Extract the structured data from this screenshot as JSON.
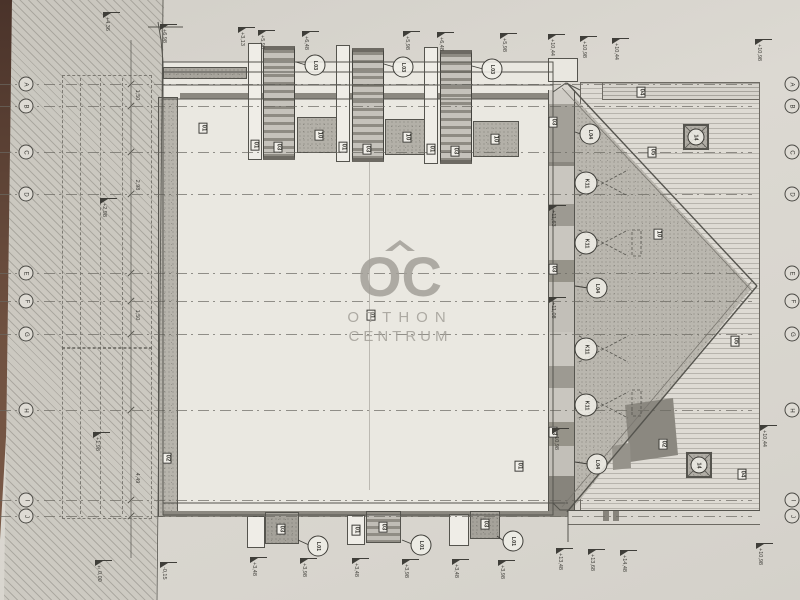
{
  "watermark": {
    "logo": "OC",
    "line1": "OTTHON",
    "line2": "CENTRUM"
  },
  "grid": {
    "x_left": 26,
    "x_right": 792,
    "rows": [
      {
        "letter": "A",
        "y": 84
      },
      {
        "letter": "B",
        "y": 106
      },
      {
        "letter": "C",
        "y": 152
      },
      {
        "letter": "D",
        "y": 194
      },
      {
        "letter": "E",
        "y": 273
      },
      {
        "letter": "F",
        "y": 301
      },
      {
        "letter": "G",
        "y": 334
      },
      {
        "letter": "H",
        "y": 410
      },
      {
        "letter": "I",
        "y": 500
      },
      {
        "letter": "J",
        "y": 516
      }
    ]
  },
  "box_labels": [
    {
      "text": "01",
      "x": 203,
      "y": 128
    },
    {
      "text": "01",
      "x": 255,
      "y": 145
    },
    {
      "text": "03",
      "x": 278,
      "y": 147
    },
    {
      "text": "10",
      "x": 319,
      "y": 135
    },
    {
      "text": "01",
      "x": 343,
      "y": 147
    },
    {
      "text": "03",
      "x": 367,
      "y": 149
    },
    {
      "text": "10",
      "x": 407,
      "y": 137
    },
    {
      "text": "01",
      "x": 431,
      "y": 149
    },
    {
      "text": "03",
      "x": 455,
      "y": 151
    },
    {
      "text": "10",
      "x": 495,
      "y": 139
    },
    {
      "text": "03",
      "x": 553,
      "y": 122
    },
    {
      "text": "03",
      "x": 553,
      "y": 269
    },
    {
      "text": "03",
      "x": 553,
      "y": 432
    },
    {
      "text": "01",
      "x": 371,
      "y": 315
    },
    {
      "text": "01",
      "x": 519,
      "y": 466
    },
    {
      "text": "02",
      "x": 167,
      "y": 458
    },
    {
      "text": "04",
      "x": 641,
      "y": 92
    },
    {
      "text": "05",
      "x": 652,
      "y": 152
    },
    {
      "text": "10",
      "x": 658,
      "y": 234
    },
    {
      "text": "05",
      "x": 735,
      "y": 341
    },
    {
      "text": "02",
      "x": 663,
      "y": 444
    },
    {
      "text": "04",
      "x": 742,
      "y": 474
    },
    {
      "text": "03",
      "x": 281,
      "y": 529
    },
    {
      "text": "01",
      "x": 356,
      "y": 530
    },
    {
      "text": "03",
      "x": 383,
      "y": 527
    },
    {
      "text": "03",
      "x": 485,
      "y": 524
    }
  ],
  "circle_labels": [
    {
      "text": "L03",
      "x": 315,
      "y": 65,
      "d": 19
    },
    {
      "text": "L03",
      "x": 403,
      "y": 67,
      "d": 19
    },
    {
      "text": "L03",
      "x": 492,
      "y": 69,
      "d": 19
    },
    {
      "text": "L04",
      "x": 590,
      "y": 134,
      "d": 19
    },
    {
      "text": "L04",
      "x": 597,
      "y": 288,
      "d": 19
    },
    {
      "text": "L04",
      "x": 597,
      "y": 464,
      "d": 19
    },
    {
      "text": "K11",
      "x": 586,
      "y": 183,
      "d": 21
    },
    {
      "text": "K11",
      "x": 586,
      "y": 243,
      "d": 21
    },
    {
      "text": "K11",
      "x": 586,
      "y": 349,
      "d": 21
    },
    {
      "text": "K11",
      "x": 586,
      "y": 405,
      "d": 21
    },
    {
      "text": "L01",
      "x": 318,
      "y": 546,
      "d": 19
    },
    {
      "text": "L01",
      "x": 421,
      "y": 545,
      "d": 19
    },
    {
      "text": "L01",
      "x": 513,
      "y": 541,
      "d": 19
    },
    {
      "text": "14",
      "x": 696,
      "y": 137,
      "d": 15
    },
    {
      "text": "14",
      "x": 699,
      "y": 465,
      "d": 15
    }
  ],
  "flags": [
    {
      "x": 103,
      "y": 12,
      "text": "+4,36"
    },
    {
      "x": 160,
      "y": 24,
      "text": "+6,98"
    },
    {
      "x": 238,
      "y": 27,
      "text": "+3,13"
    },
    {
      "x": 258,
      "y": 30,
      "text": "+5,98"
    },
    {
      "x": 302,
      "y": 31,
      "text": "+6,48"
    },
    {
      "x": 403,
      "y": 31,
      "text": "+5,98"
    },
    {
      "x": 437,
      "y": 32,
      "text": "+6,48"
    },
    {
      "x": 500,
      "y": 33,
      "text": "+5,98"
    },
    {
      "x": 548,
      "y": 34,
      "text": "+10,44"
    },
    {
      "x": 580,
      "y": 36,
      "text": "+10,98"
    },
    {
      "x": 612,
      "y": 38,
      "text": "+10,44"
    },
    {
      "x": 755,
      "y": 39,
      "text": "+10,98"
    },
    {
      "x": 760,
      "y": 425,
      "text": "+10,44"
    },
    {
      "x": 756,
      "y": 543,
      "text": "+10,98"
    },
    {
      "x": 549,
      "y": 205,
      "text": "+11,63"
    },
    {
      "x": 549,
      "y": 297,
      "text": "+11,08"
    },
    {
      "x": 552,
      "y": 428,
      "text": "+10,98"
    },
    {
      "x": 100,
      "y": 198,
      "text": "+2,98"
    },
    {
      "x": 93,
      "y": 432,
      "text": "+1,98"
    },
    {
      "x": 250,
      "y": 557,
      "text": "+3,48"
    },
    {
      "x": 300,
      "y": 558,
      "text": "+3,98"
    },
    {
      "x": 352,
      "y": 558,
      "text": "+3,48"
    },
    {
      "x": 402,
      "y": 559,
      "text": "+3,98"
    },
    {
      "x": 452,
      "y": 559,
      "text": "+3,48"
    },
    {
      "x": 498,
      "y": 560,
      "text": "+3,98"
    },
    {
      "x": 556,
      "y": 548,
      "text": "+13,48"
    },
    {
      "x": 588,
      "y": 549,
      "text": "+13,68"
    },
    {
      "x": 620,
      "y": 550,
      "text": "+14,48"
    },
    {
      "x": 95,
      "y": 560,
      "text": "±0,00"
    },
    {
      "x": 160,
      "y": 562,
      "text": "-0,15"
    }
  ],
  "dim_texts": [
    {
      "text": "1,50",
      "x": 137,
      "y": 95
    },
    {
      "text": "2,98",
      "x": 137,
      "y": 185
    },
    {
      "text": "1,50",
      "x": 137,
      "y": 315
    },
    {
      "text": "4,49",
      "x": 137,
      "y": 478
    }
  ],
  "colors": {
    "paper": "#d8d5ce",
    "ink": "#55544e",
    "table_brown": "#6f5140",
    "watermark_gray": "#a3a099"
  }
}
